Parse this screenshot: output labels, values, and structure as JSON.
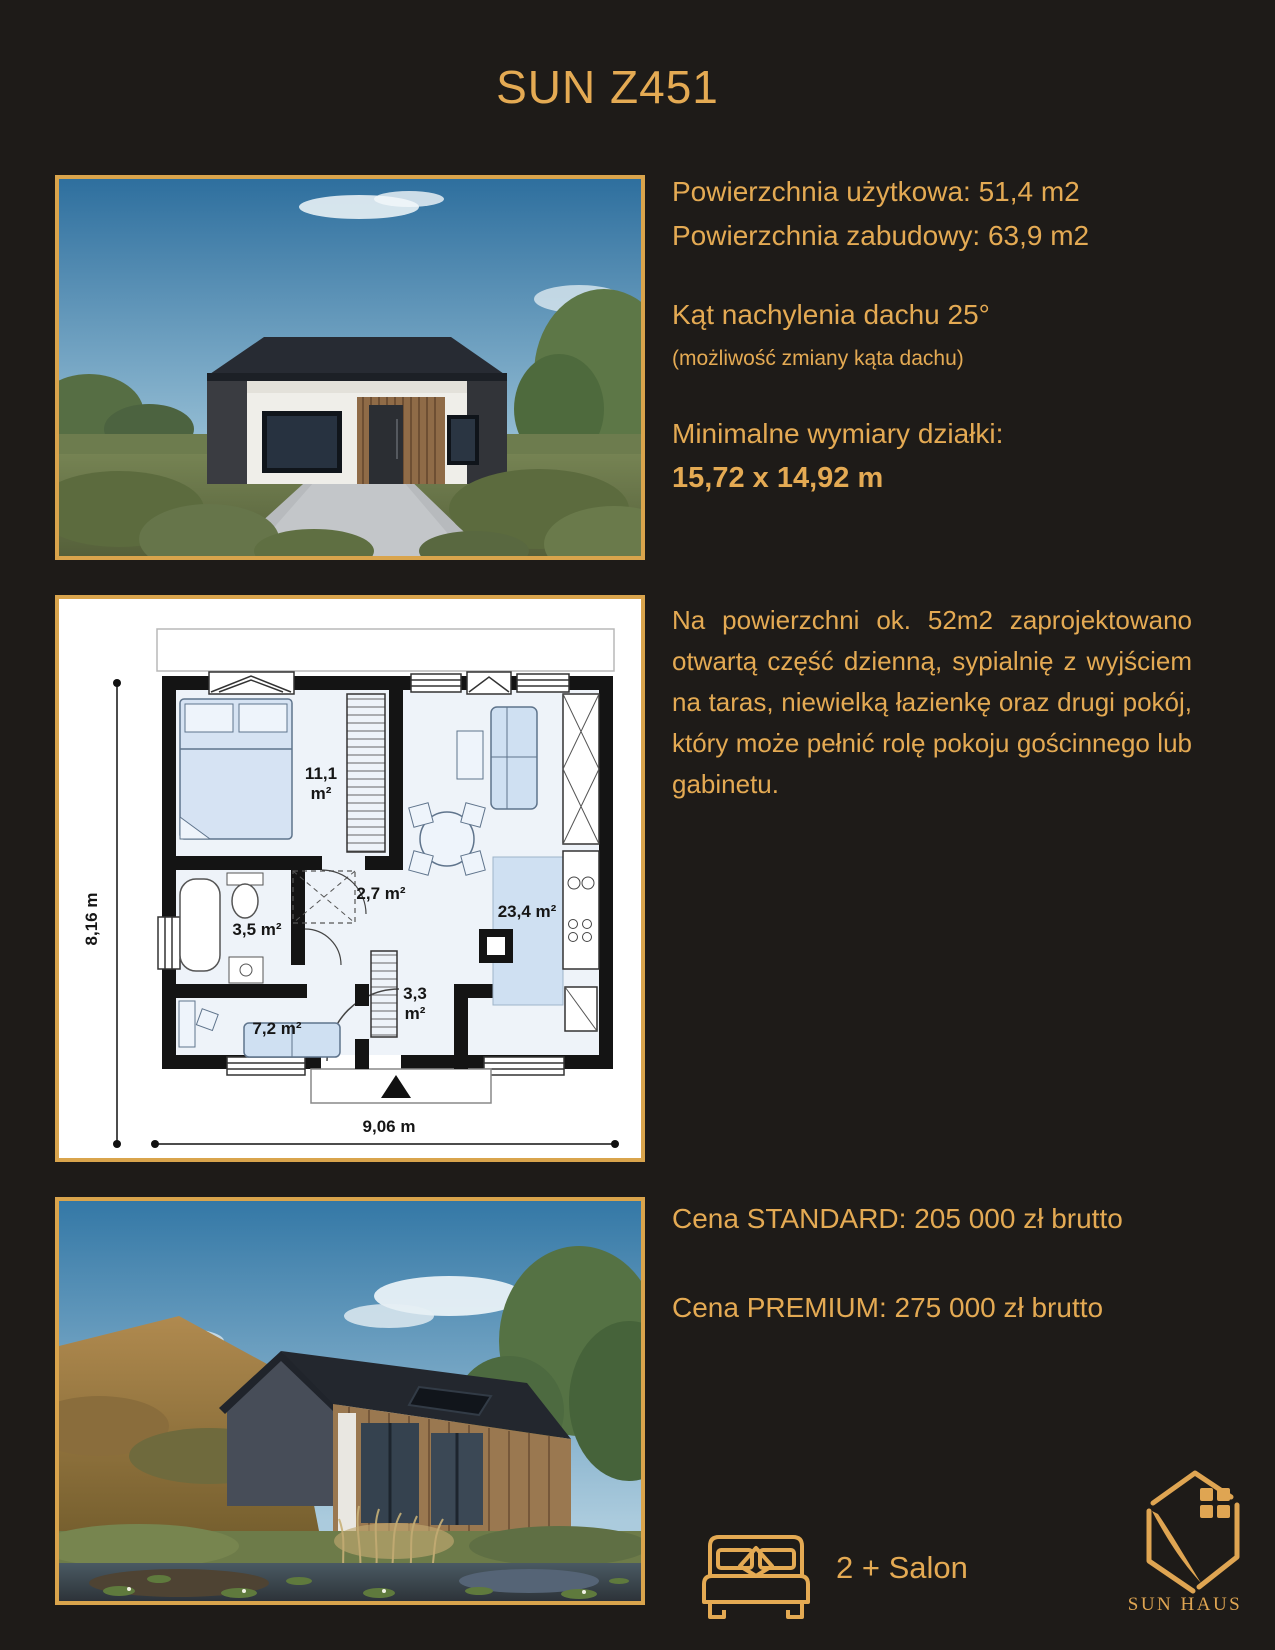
{
  "page": {
    "title": "SUN Z451",
    "bg_color": "#1e1b18",
    "accent_color": "#e4aa53",
    "border_color": "#d9a44c"
  },
  "specs": {
    "usable_area": "Powierzchnia użytkowa: 51,4 m2",
    "built_area": "Powierzchnia zabudowy: 63,9 m2",
    "roof_angle": "Kąt nachylenia dachu 25°",
    "roof_note": "(możliwość zmiany kąta dachu)",
    "plot_label": "Minimalne wymiary działki:",
    "plot_size": "15,72 x 14,92 m"
  },
  "description": "Na powierzchni ok. 52m2 zaprojektowano otwartą część dzienną, sypialnię z wyjściem na taras, niewielką łazienkę oraz drugi pokój, który może pełnić rolę pokoju gościnnego lub gabinetu.",
  "floorplan": {
    "dim_height": "8,16 m",
    "dim_width": "9,06 m",
    "rooms": [
      {
        "id": "bedroom",
        "area": "11,1",
        "unit": "m²"
      },
      {
        "id": "hall",
        "area": "2,7 m²"
      },
      {
        "id": "bathroom",
        "area": "3,5 m²"
      },
      {
        "id": "living",
        "area": "23,4 m²"
      },
      {
        "id": "hall2",
        "area": "3,3",
        "unit": "m²"
      },
      {
        "id": "room",
        "area": "7,2 m²"
      }
    ]
  },
  "prices": {
    "standard": "Cena STANDARD: 205 000 zł brutto",
    "premium": "Cena PREMIUM: 275 000 zł brutto"
  },
  "footer": {
    "rooms_label": "2 + Salon",
    "brand": "SUN HAUS"
  }
}
